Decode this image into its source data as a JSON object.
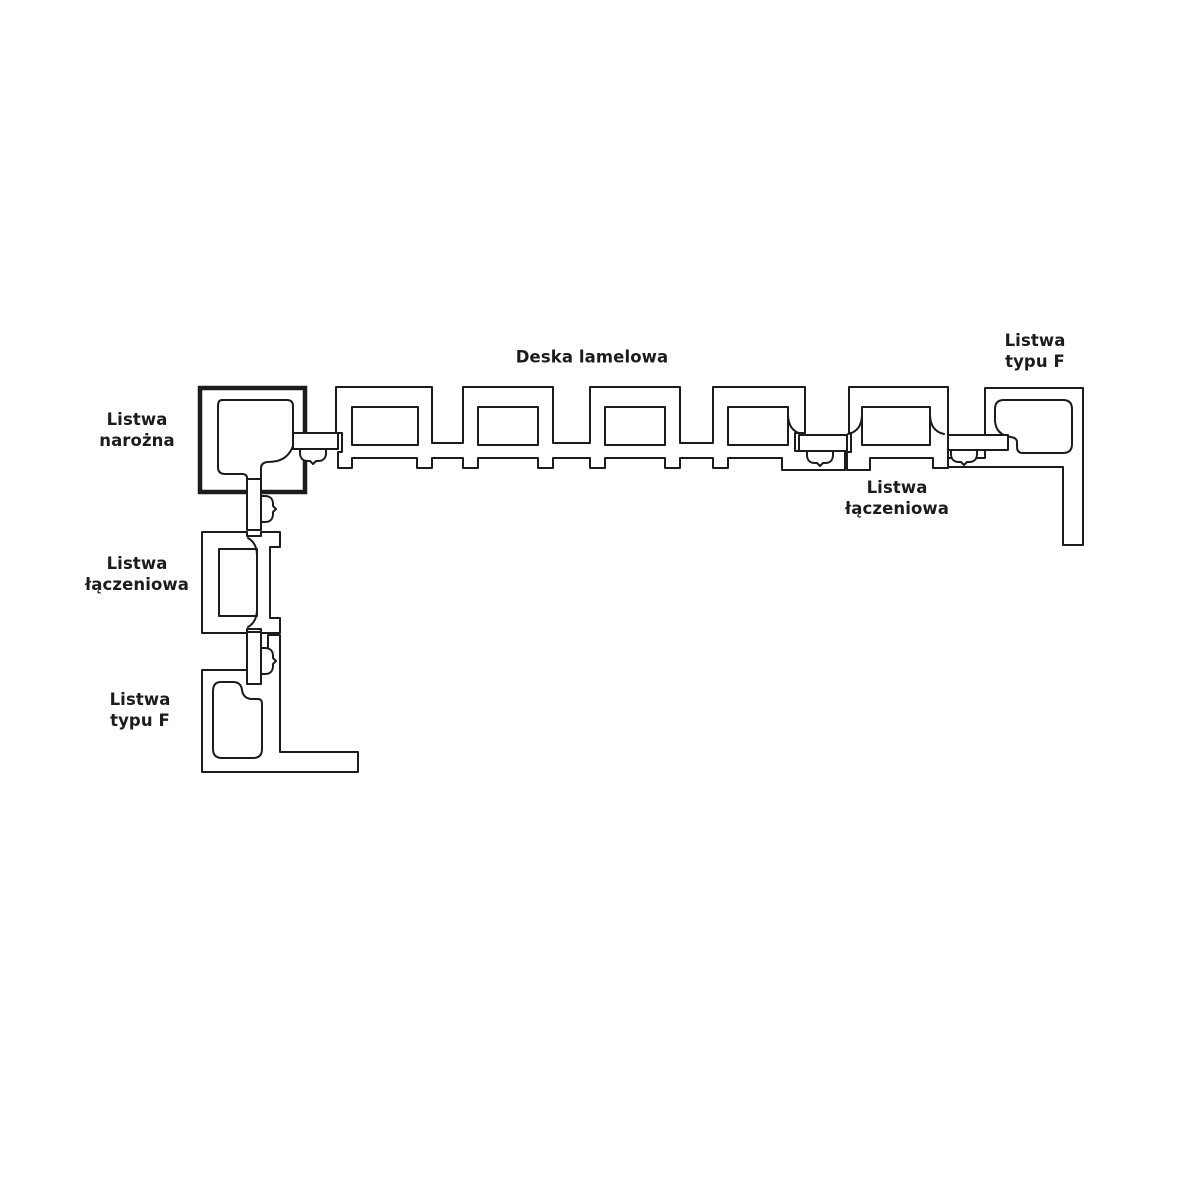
{
  "diagram": {
    "description": "Cross-section diagram of lamella wall panel system with trim strips",
    "colors": {
      "line": "#1c1c1c",
      "background": "#ffffff"
    },
    "labels": {
      "deska_lamelowa": "Deska lamelowa",
      "f_strip_top_right": "Listwa\ntypu F",
      "corner_strip": "Listwa\nnarożna",
      "connector_strip_left": "Listwa\nłączeniowa",
      "f_strip_bottom_left": "Listwa\ntypu F",
      "connector_strip_right": "Listwa\nłączeniowa"
    }
  }
}
